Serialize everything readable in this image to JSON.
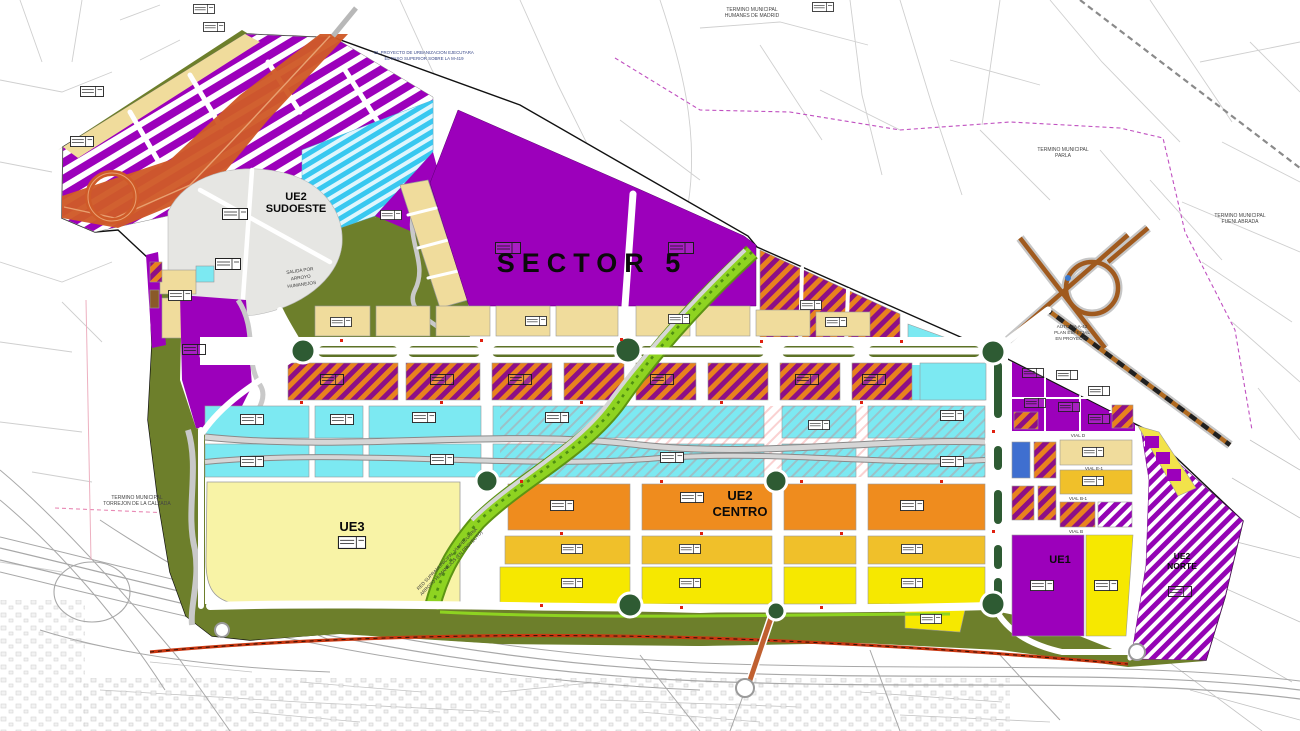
{
  "map": {
    "title": "Plan de sectorizacion - Sector 5",
    "zone_labels": {
      "sector5": "SECTOR 5",
      "ue1": "UE1",
      "ue3": "UE3",
      "ue2_centro_1": "UE2",
      "ue2_centro_2": "CENTRO",
      "ue2_sudoeste_1": "UE2",
      "ue2_sudoeste_2": "SUDOESTE",
      "ue2_norte_1": "UE2",
      "ue2_norte_2": "NORTE"
    },
    "municipal_labels": {
      "humanes_1": "TERMINO MUNICIPAL",
      "humanes_2": "HUMANES DE MADRID",
      "parla_1": "TERMINO MUNICIPAL",
      "parla_2": "PARLA",
      "fuenlabrada_1": "TERMINO MUNICIPAL",
      "fuenlabrada_2": "FUENLABRADA",
      "torrejon_1": "TERMINO MUNICIPAL",
      "torrejon_2": "TORREJON DE LA CALZADA"
    },
    "notes": {
      "salida_1": "SALIDA POR",
      "salida_2": "ARROYO",
      "salida_3": "HUMANEJOS",
      "proyecto_1": "EL PROYECTO DE URBANIZACION EJECUTARA",
      "proyecto_2": "EL PASO SUPERIOR SOBRE LA M-419",
      "autovia_1": "AUTOVIA A-42",
      "autovia_2": "PLAN ESPECIAL",
      "autovia_3": "EN PROYECTO",
      "pecuaria_1": "RED SUPRAMUNICIPAL VIA PECUARIA",
      "pecuaria_2": "ARROYO HUMANEJOS (EN PROYECTO)"
    },
    "road_labels": {
      "vial_d": "VIAL D",
      "vial_e1": "VIAL E-1",
      "vial_b1": "VIAL B-1",
      "vial_b": "VIAL B"
    },
    "colors": {
      "purple": "#9c00bb",
      "hatch_purple": "#8d0f86",
      "hatch_orange": "#e8821e",
      "cyan": "#7ce9f2",
      "orange": "#ef8c1e",
      "gold": "#f0c02a",
      "yellow": "#f6e800",
      "tan": "#f0dc9c",
      "pale_yellow": "#f8f3a6",
      "olive": "#6d7f2b",
      "roundabout_green": "#2e5b33",
      "railway_red": "#c93812",
      "highway_orange": "#cf5a28",
      "corridor_green": "#8ed321",
      "gray_zone": "#e6e6e3",
      "blue_parcel": "#3f6fd0"
    }
  }
}
